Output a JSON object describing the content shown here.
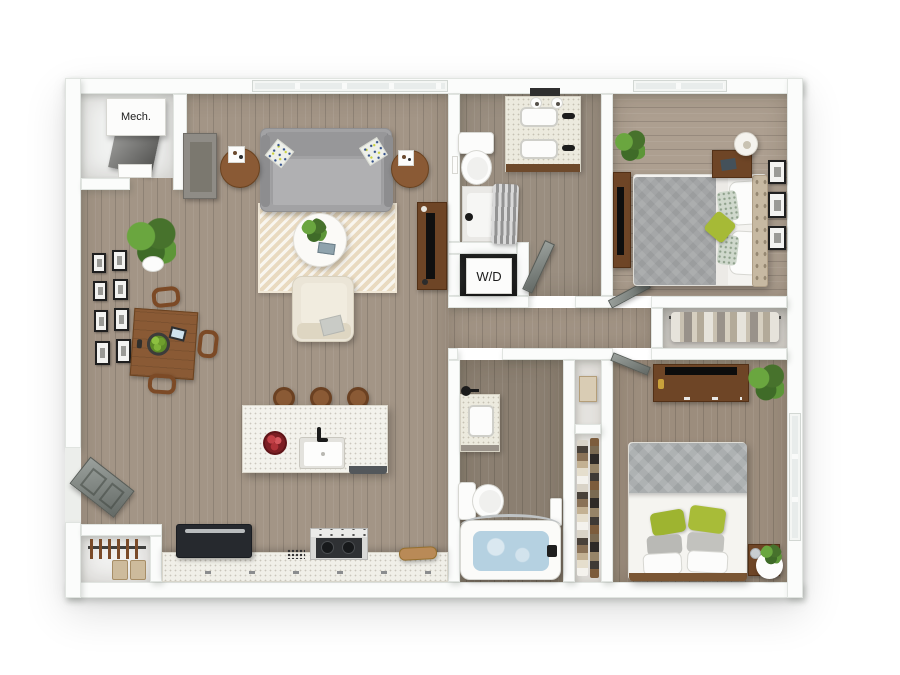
{
  "scene": {
    "description": "3D cutaway floor plan rendering of a two-bedroom, two-bathroom apartment viewed from above",
    "text_labels": {
      "mechanical_closet": "Mech.",
      "washer_dryer_closet": "W/D"
    },
    "rooms": [
      "living-room",
      "dining-area",
      "kitchen",
      "hallway",
      "bathroom-1",
      "bathroom-2",
      "bedroom-1",
      "bedroom-2",
      "mechanical-closet",
      "laundry-closet",
      "entry-closet",
      "bedroom-closet",
      "linen-closet"
    ],
    "palette": {
      "background": "#ffffff",
      "wall": "#fbfcfb",
      "wall_edge": "#e0e4e0",
      "floor_living": "#a39586",
      "floor_bedroom_1": "#ad9f90",
      "floor_bedroom_2": "#9c8d7d",
      "floor_bath_1": "#9a8e80",
      "floor_bath_2": "#8b7f71",
      "rug": "#e9dac0",
      "sofa_gray": "#a2a2a4",
      "accent_green_pillow": "#a4b833",
      "wood_furniture": "#8a5a35",
      "dark_walnut": "#6e4526",
      "countertop": "#f1efe8",
      "tub_water": "#b5d1e1",
      "appliance_dark": "#26292e"
    }
  }
}
